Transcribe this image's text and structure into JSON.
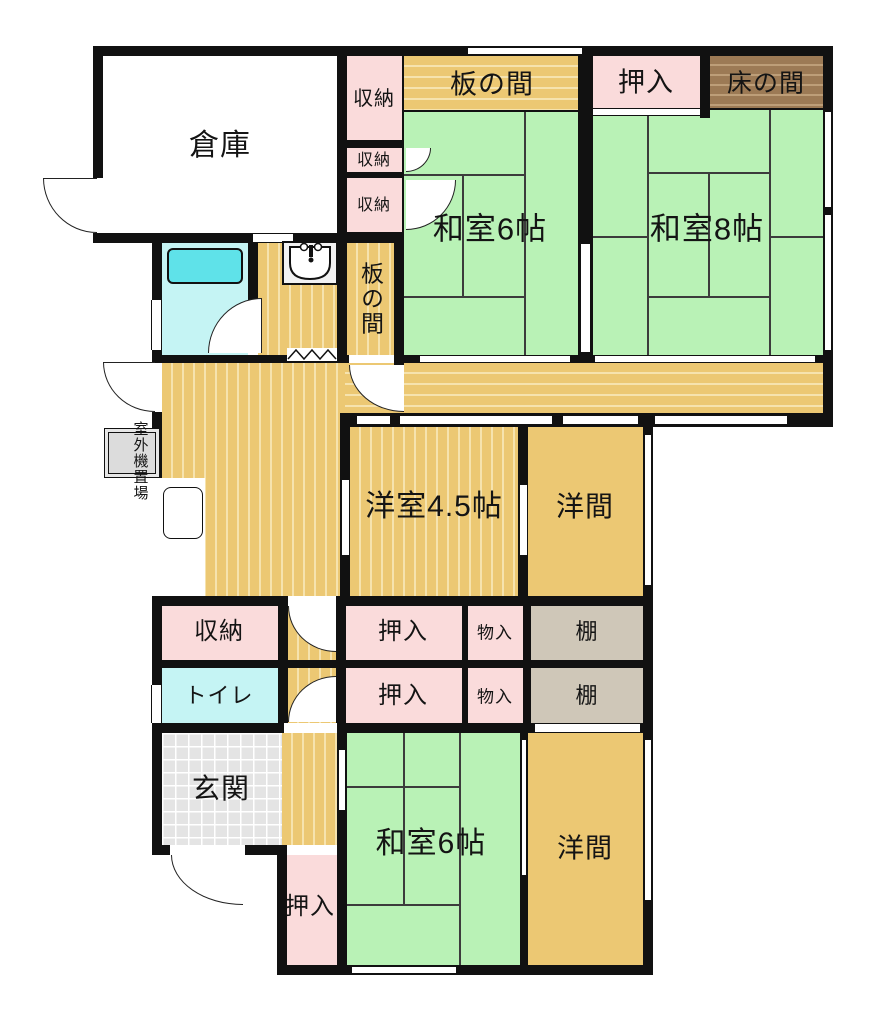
{
  "plan_title": "間取り図",
  "rooms": {
    "warehouse": "倉庫",
    "storage_top": "収納",
    "storage_small_a": "収納",
    "storage_small_b": "収納",
    "itanoma_top": "板の間",
    "oshiire_top": "押入",
    "tokonoma": "床の間",
    "washitsu6_top": "和室6帖",
    "washitsu8": "和室8帖",
    "itanoma_side": "板の間",
    "yoshitsu45": "洋室4.5帖",
    "yoma_mid": "洋間",
    "storage_mid": "収納",
    "oshiire_mid_upper": "押入",
    "monoire_upper": "物入",
    "tana_upper": "棚",
    "toilet": "トイレ",
    "oshiire_mid_lower": "押入",
    "monoire_lower": "物入",
    "tana_lower": "棚",
    "genkan": "玄関",
    "oshiire_bottom": "押入",
    "washitsu6_bottom": "和室6帖",
    "yoma_bottom": "洋間",
    "outdoor_unit": "室外機置場"
  },
  "icons": {
    "sink": "sink-icon",
    "accordion_door": "accordion-door-zigzag",
    "door_swing": "door-swing-arc"
  },
  "colors": {
    "wall": "#111111",
    "tatami_green": "#b9f2b6",
    "wood_tan": "#ecc873",
    "wood_stripe": "#f6e3ae",
    "closet_pink": "#fadbdb",
    "tokonoma_brown": "#9c7a55",
    "shelf_gray": "#cfc7b8",
    "bath_cyan": "#c5f4f4",
    "bathtub_cyan": "#5fe2e9",
    "genkan_tile": "#e4e4e4"
  }
}
